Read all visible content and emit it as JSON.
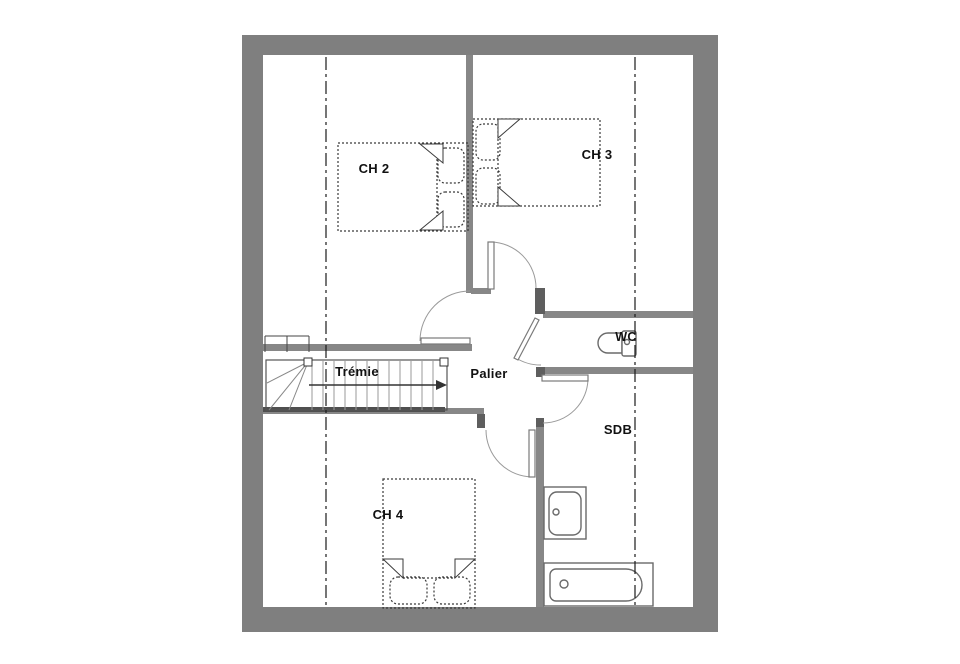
{
  "window": {
    "background": "#ffffff"
  },
  "colors": {
    "wall_outer": "#7f7f7f",
    "wall_inner": "#878787",
    "wall_stub": "#5e5e5e",
    "stair_dark": "#4f4f4f",
    "drawing_line": "#3a3a3a",
    "fixture_line": "#6a6a6a",
    "door_arc": "#9a9a9a",
    "label_text": "#111111"
  },
  "labels": {
    "ch2": "CH 2",
    "ch3": "CH 3",
    "ch4": "CH 4",
    "tremie": "Trémie",
    "palier": "Palier",
    "wc": "WC",
    "sdb": "SDB"
  },
  "fixtures": {
    "ch2_bed": "double-bed",
    "ch3_bed": "double-bed",
    "ch4_bed": "double-bed",
    "staircase": "staircase-up-arrow",
    "toilet": "toilet",
    "washbasin": "washbasin",
    "bathtub": "bathtub"
  }
}
